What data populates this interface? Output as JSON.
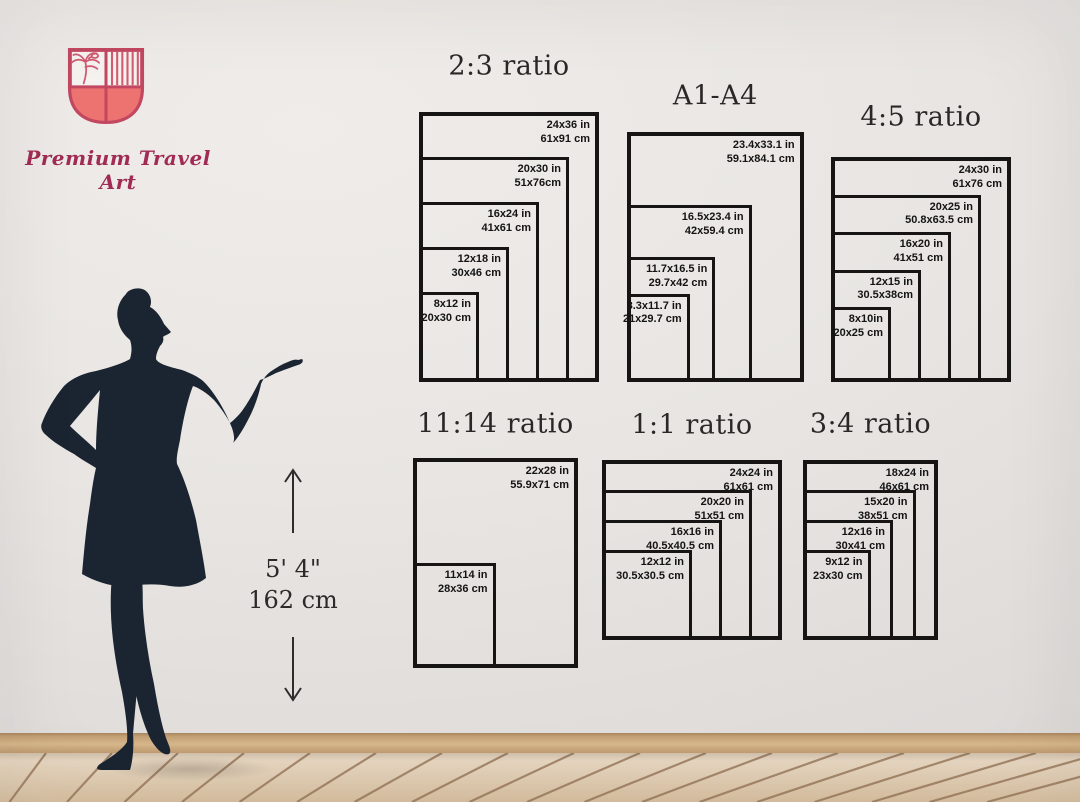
{
  "brand": {
    "name": "Premium Travel Art",
    "logo_colors": {
      "outline": "#c24760",
      "fill": "#ec7370",
      "stripe": "#d15b70",
      "wall_panel": "#f4f1ee"
    }
  },
  "height_marker": {
    "feet_label": "5' 4\"",
    "cm_label": "162 cm"
  },
  "size_groups": [
    {
      "id": "2-3",
      "title": "2:3 ratio",
      "sizes": [
        {
          "w_in": 24,
          "h_in": 36,
          "label_in": "24x36 in",
          "label_cm": "61x91 cm"
        },
        {
          "w_in": 20,
          "h_in": 30,
          "label_in": "20x30 in",
          "label_cm": "51x76cm"
        },
        {
          "w_in": 16,
          "h_in": 24,
          "label_in": "16x24 in",
          "label_cm": "41x61 cm"
        },
        {
          "w_in": 12,
          "h_in": 18,
          "label_in": "12x18 in",
          "label_cm": "30x46 cm"
        },
        {
          "w_in": 8,
          "h_in": 12,
          "label_in": "8x12 in",
          "label_cm": "20x30 cm"
        }
      ]
    },
    {
      "id": "a1-a4",
      "title": "A1-A4",
      "sizes": [
        {
          "w_in": 23.4,
          "h_in": 33.1,
          "label_in": "23.4x33.1 in",
          "label_cm": "59.1x84.1 cm"
        },
        {
          "w_in": 16.5,
          "h_in": 23.4,
          "label_in": "16.5x23.4 in",
          "label_cm": "42x59.4 cm"
        },
        {
          "w_in": 11.7,
          "h_in": 16.5,
          "label_in": "11.7x16.5 in",
          "label_cm": "29.7x42 cm"
        },
        {
          "w_in": 8.3,
          "h_in": 11.7,
          "label_in": "8.3x11.7 in",
          "label_cm": "21x29.7 cm"
        }
      ]
    },
    {
      "id": "4-5",
      "title": "4:5 ratio",
      "sizes": [
        {
          "w_in": 24,
          "h_in": 30,
          "label_in": "24x30 in",
          "label_cm": "61x76 cm"
        },
        {
          "w_in": 20,
          "h_in": 25,
          "label_in": "20x25 in",
          "label_cm": "50.8x63.5 cm"
        },
        {
          "w_in": 16,
          "h_in": 20,
          "label_in": "16x20 in",
          "label_cm": "41x51 cm"
        },
        {
          "w_in": 12,
          "h_in": 15,
          "label_in": "12x15 in",
          "label_cm": "30.5x38cm"
        },
        {
          "w_in": 8,
          "h_in": 10,
          "label_in": "8x10in",
          "label_cm": "20x25 cm"
        }
      ]
    },
    {
      "id": "11-14",
      "title": "11:14 ratio",
      "sizes": [
        {
          "w_in": 22,
          "h_in": 28,
          "label_in": "22x28 in",
          "label_cm": "55.9x71 cm"
        },
        {
          "w_in": 11,
          "h_in": 14,
          "label_in": "11x14 in",
          "label_cm": "28x36 cm"
        }
      ]
    },
    {
      "id": "1-1",
      "title": "1:1 ratio",
      "sizes": [
        {
          "w_in": 24,
          "h_in": 24,
          "label_in": "24x24 in",
          "label_cm": "61x61 cm"
        },
        {
          "w_in": 20,
          "h_in": 20,
          "label_in": "20x20 in",
          "label_cm": "51x51 cm"
        },
        {
          "w_in": 16,
          "h_in": 16,
          "label_in": "16x16 in",
          "label_cm": "40.5x40.5 cm"
        },
        {
          "w_in": 12,
          "h_in": 12,
          "label_in": "12x12 in",
          "label_cm": "30.5x30.5 cm"
        }
      ]
    },
    {
      "id": "3-4",
      "title": "3:4 ratio",
      "sizes": [
        {
          "w_in": 18,
          "h_in": 24,
          "label_in": "18x24 in",
          "label_cm": "46x61 cm"
        },
        {
          "w_in": 15,
          "h_in": 20,
          "label_in": "15x20 in",
          "label_cm": "38x51 cm"
        },
        {
          "w_in": 12,
          "h_in": 16,
          "label_in": "12x16 in",
          "label_cm": "30x41 cm"
        },
        {
          "w_in": 9,
          "h_in": 12,
          "label_in": "9x12 in",
          "label_cm": "23x30 cm"
        }
      ]
    }
  ]
}
